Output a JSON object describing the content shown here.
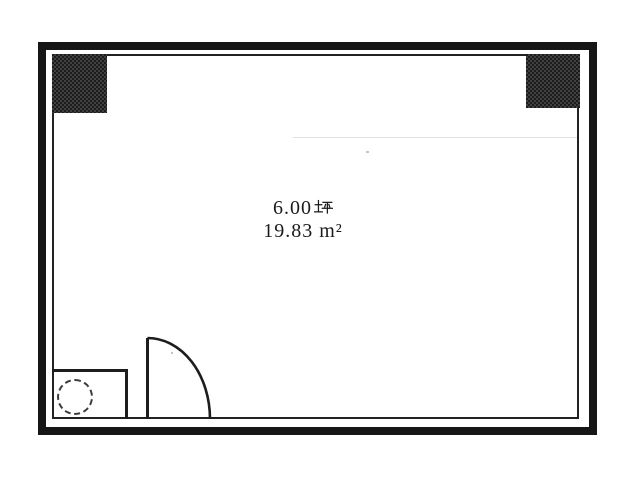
{
  "floor_plan": {
    "area_tsubo": {
      "value": "6.00",
      "unit": "坪"
    },
    "area_sqm": "19.83 m²",
    "colors": {
      "wall": "#161616",
      "inner_line": "#222222",
      "column_fill": "#1c1c1c",
      "door_line": "#1d1d1d",
      "background": "#ffffff",
      "faint_scan_line": "#e3e3e3"
    }
  }
}
